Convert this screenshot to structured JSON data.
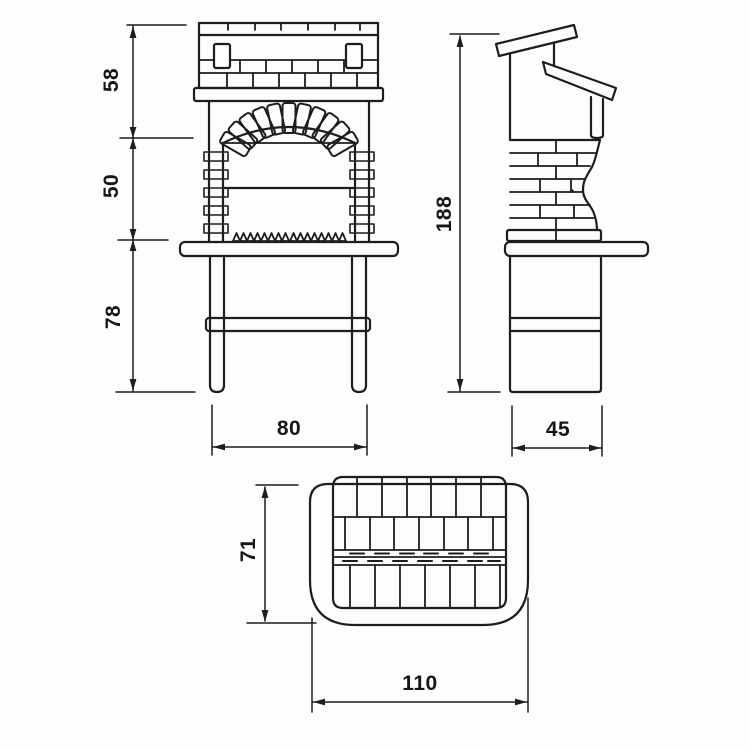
{
  "drawing": {
    "kind": "technical-drawing",
    "subject": "masonry barbecue, three orthographic views"
  },
  "colors": {
    "background": "#fdfdfd",
    "line": "#1d1d1d",
    "label": "#161616"
  },
  "dimensions": {
    "front": {
      "upper_height": "58",
      "middle_height": "50",
      "lower_height": "78",
      "width": "80"
    },
    "side": {
      "overall_height": "188",
      "base_depth": "45"
    },
    "top": {
      "depth": "71",
      "width": "110"
    }
  }
}
